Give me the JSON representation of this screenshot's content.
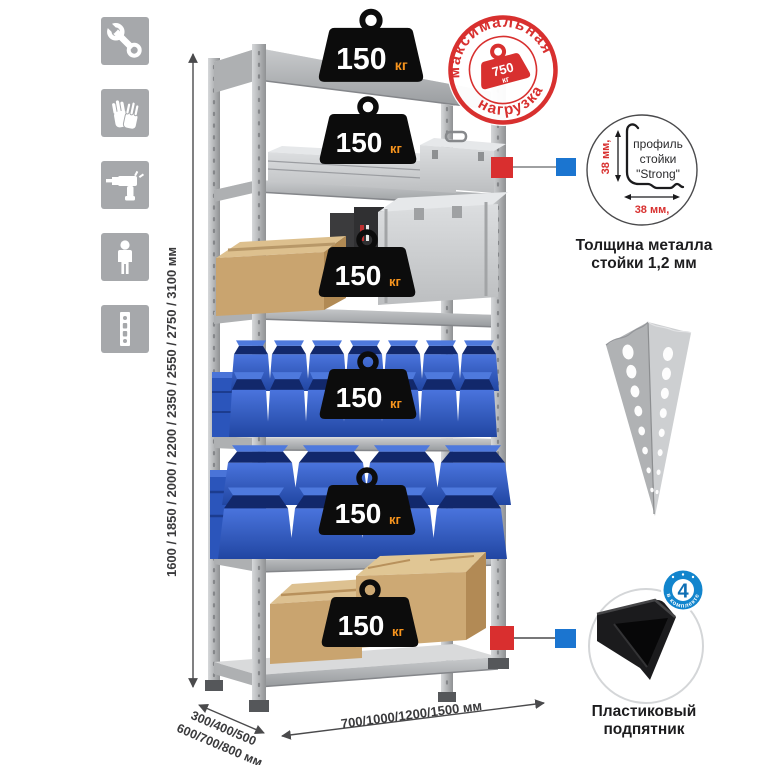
{
  "left_icons": [
    "wrench",
    "gloves",
    "drill",
    "person",
    "rack-profile"
  ],
  "height_dimension_label": "1600 / 1850 / 2000 / 2200 / 2350 / 2550 / 2750 / 3100 мм",
  "shelf_weights": [
    {
      "value": "150",
      "unit": "кг"
    },
    {
      "value": "150",
      "unit": "кг"
    },
    {
      "value": "150",
      "unit": "кг"
    },
    {
      "value": "150",
      "unit": "кг"
    },
    {
      "value": "150",
      "unit": "кг"
    },
    {
      "value": "150",
      "unit": "кг"
    }
  ],
  "max_load_stamp": {
    "arc_top": "максимальная",
    "arc_bottom": "нагрузка",
    "value": "750",
    "unit": "кг"
  },
  "profile_detail": {
    "line1": "профиль",
    "line2": "стойки",
    "line3": "\"Strong\"",
    "dim_vertical": "38 мм,",
    "dim_horizontal": "38 мм,",
    "caption_line1": "Толщина металла",
    "caption_line2": "стойки 1,2 мм"
  },
  "foot_detail": {
    "badge_value": "4",
    "badge_ring_text": "в комплекте",
    "caption_line1": "Пластиковый",
    "caption_line2": "подпятник"
  },
  "depth_dimension": {
    "line1": "300/400/500",
    "line2": "600/700/800 мм"
  },
  "width_dimension_label": "700/1000/1200/1500 мм",
  "colors": {
    "stamp_red": "#d8302f",
    "connector_red": "#d92f2f",
    "connector_blue": "#1b75d0",
    "badge_blue": "#1285cd",
    "weight_black": "#0c0c0c",
    "kg_orange": "#f7941d",
    "bin_blue": "#2d5bc8",
    "cardboard_tan": "#c9a46f",
    "metal_gray": "#b6b8ba",
    "icon_gray": "#a6a8ab"
  }
}
